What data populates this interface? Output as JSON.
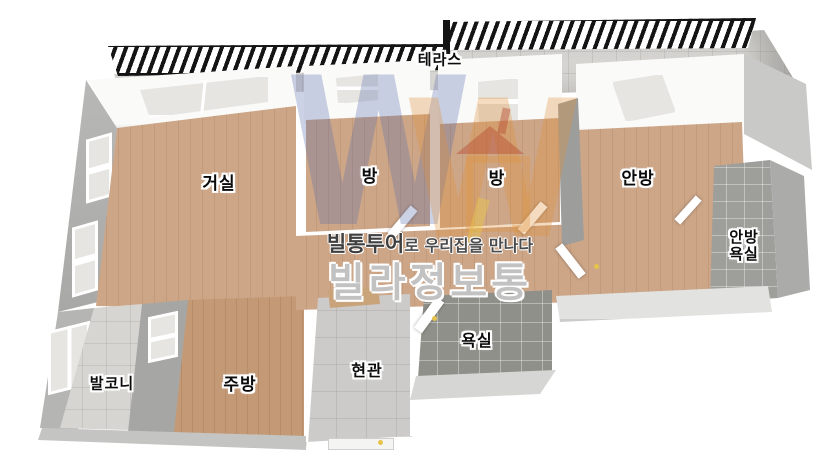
{
  "rooms": {
    "terrace": {
      "label": "테라스"
    },
    "living": {
      "label": "거실"
    },
    "room1": {
      "label": "방"
    },
    "room2": {
      "label": "방"
    },
    "master": {
      "label": "안방"
    },
    "master_bath": {
      "label": "안방\n욕실"
    },
    "balcony": {
      "label": "발코니"
    },
    "kitchen": {
      "label": "주방"
    },
    "entrance": {
      "label": "현관"
    },
    "bath": {
      "label": "욕실"
    }
  },
  "watermark": {
    "brand": "빌통투어",
    "tagline": "로 우리집을 만나다",
    "big": "빌라정보통",
    "logo_letter": "W"
  },
  "colors": {
    "wood": "#cda688",
    "wood_dark": "#c49a76",
    "tile_dark": "#90908a",
    "tile_mid": "#9e9e9a",
    "tile_light": "#cccbc9",
    "tile_pale": "#d7d5d1",
    "wall_white": "#fafaf9",
    "wall_gray": "#9d9d9b",
    "wall_gray_mid": "#b3b3b1",
    "wall_gray_light": "#c9c9c7",
    "railing": "#141414",
    "logo_blue": "rgba(85,105,170,0.30)",
    "logo_orange": "rgba(225,145,60,0.32)",
    "logo_red": "rgba(180,70,45,0.42)",
    "logo_yellow": "rgba(235,200,70,0.45)",
    "handle_yellow": "#e6c34a",
    "watermark_gray": "rgba(150,150,150,0.58)"
  }
}
